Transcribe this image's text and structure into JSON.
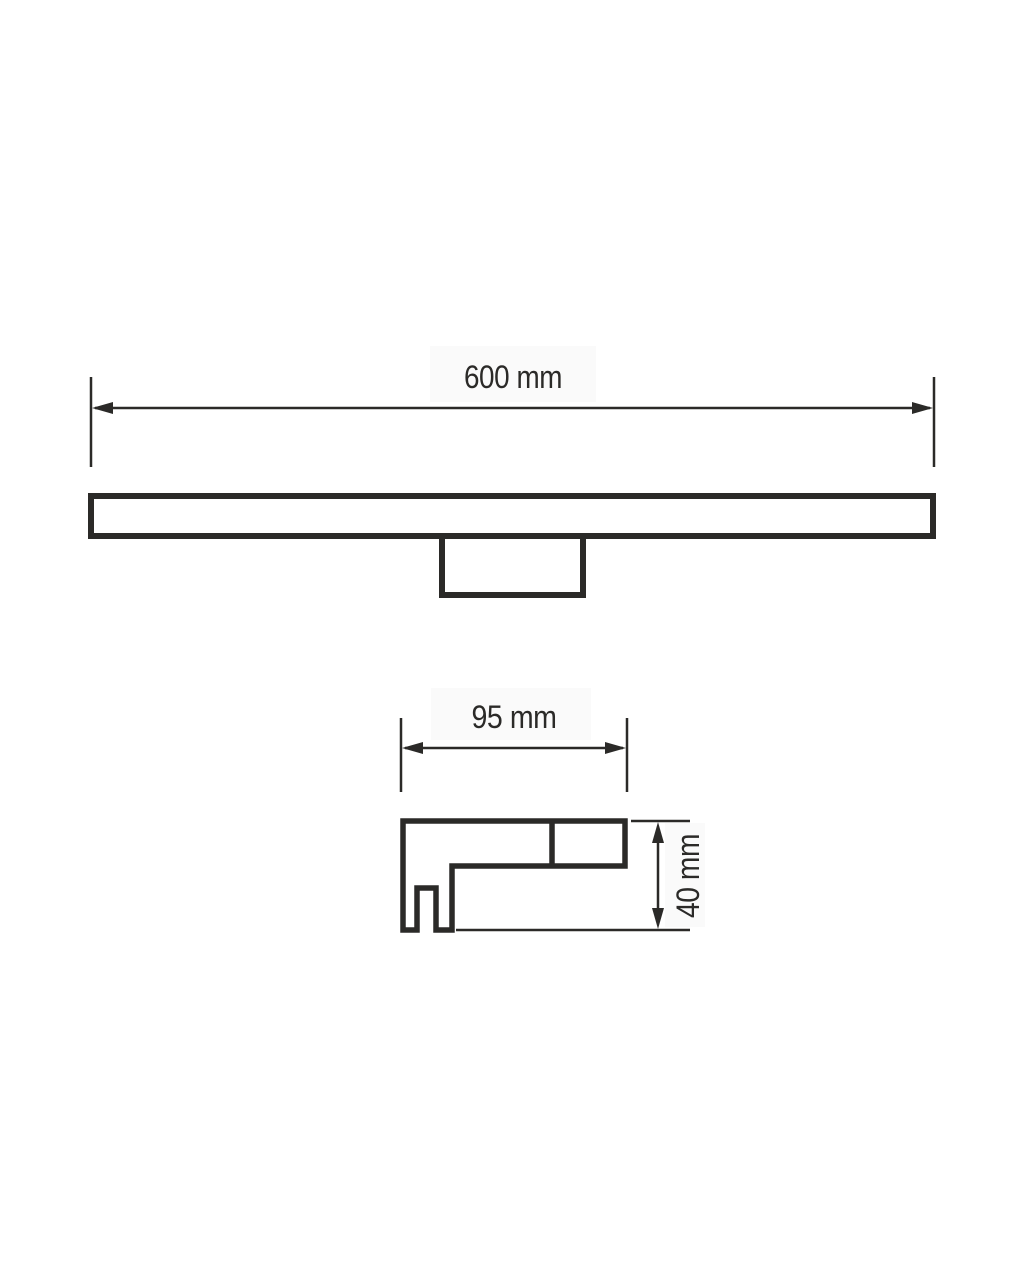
{
  "page": {
    "background_color": "#ffffff"
  },
  "drawing": {
    "line_color": "#2b2a28",
    "label_background_color": "#fafafa",
    "front_view": {
      "width_dimension": {
        "label": "600 mm",
        "value": 600,
        "unit": "mm"
      }
    },
    "side_view": {
      "width_dimension": {
        "label": "95 mm",
        "value": 95,
        "unit": "mm"
      },
      "height_dimension": {
        "label": "40 mm",
        "value": 40,
        "unit": "mm"
      }
    }
  }
}
